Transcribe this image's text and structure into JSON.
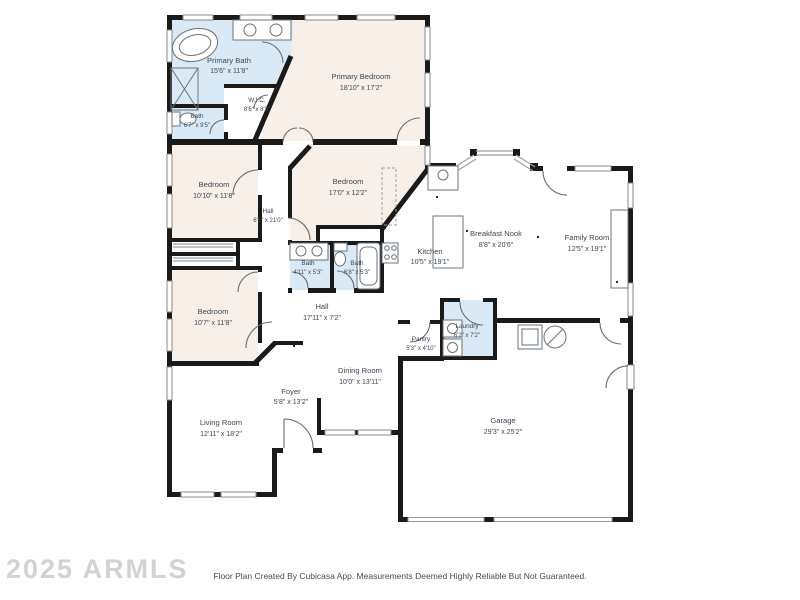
{
  "watermark": "2025 ARMLS",
  "footer": "Floor Plan Created By Cubicasa App. Measurements Deemed Highly Reliable But Not Guaranteed.",
  "colors": {
    "bedroom_fill": "#f8efe9",
    "bath_fill": "#d9e9f6",
    "wall": "#1a1a1a",
    "label_text": "#3d4753",
    "window_stroke": "#8a8a8a",
    "fixture_stroke": "#6a737b",
    "watermark_color": "#d2d2d2",
    "footer_color": "#4a4a4a"
  },
  "icons": {
    "bathtub-icon": "ellipse-outline",
    "shower-icon": "crossed-box",
    "toilet-icon": "tank-and-bowl",
    "sink-icon": "circle-basin",
    "stove-icon": "four-burners",
    "washer-icon": "square-drum",
    "dryer-icon": "square-drum",
    "water-heater-icon": "circle-slash",
    "furnace-icon": "square",
    "door-icon": "quarter-arc",
    "window-icon": "double-line"
  },
  "rooms": [
    {
      "name": "Primary Bath",
      "dims": "15'6\" x 11'8\""
    },
    {
      "name": "Bath",
      "dims": "6'7\" x 9'5\""
    },
    {
      "name": "W.I.C.",
      "dims": "8'6\" x 8'3\""
    },
    {
      "name": "Primary Bedroom",
      "dims": "18'10\" x 17'2\""
    },
    {
      "name": "Bedroom",
      "dims": "10'10\" x 11'8\""
    },
    {
      "name": "Bedroom",
      "dims": "17'0\" x 12'2\""
    },
    {
      "name": "Hall",
      "dims": "6'5\" x 21'0\""
    },
    {
      "name": "Bath",
      "dims": "4'11\" x 5'3\""
    },
    {
      "name": "Bath",
      "dims": "6'8\" x 5'3\""
    },
    {
      "name": "Kitchen",
      "dims": "10'5\" x 19'1\""
    },
    {
      "name": "Breakfast Nook",
      "dims": "8'8\" x 20'6\""
    },
    {
      "name": "Family Room",
      "dims": "12'5\" x 19'1\""
    },
    {
      "name": "Bedroom",
      "dims": "10'7\" x 11'8\""
    },
    {
      "name": "Hall",
      "dims": "17'11\" x 7'2\""
    },
    {
      "name": "Pantry",
      "dims": "5'3\" x 4'10\""
    },
    {
      "name": "Laundry",
      "dims": "6'2\" x 7'2\""
    },
    {
      "name": "Dining Room",
      "dims": "10'0\" x 13'11\""
    },
    {
      "name": "Foyer",
      "dims": "5'8\" x 13'2\""
    },
    {
      "name": "Living Room",
      "dims": "12'11\" x 18'2\""
    },
    {
      "name": "Garage",
      "dims": "29'3\" x 25'2\""
    }
  ]
}
